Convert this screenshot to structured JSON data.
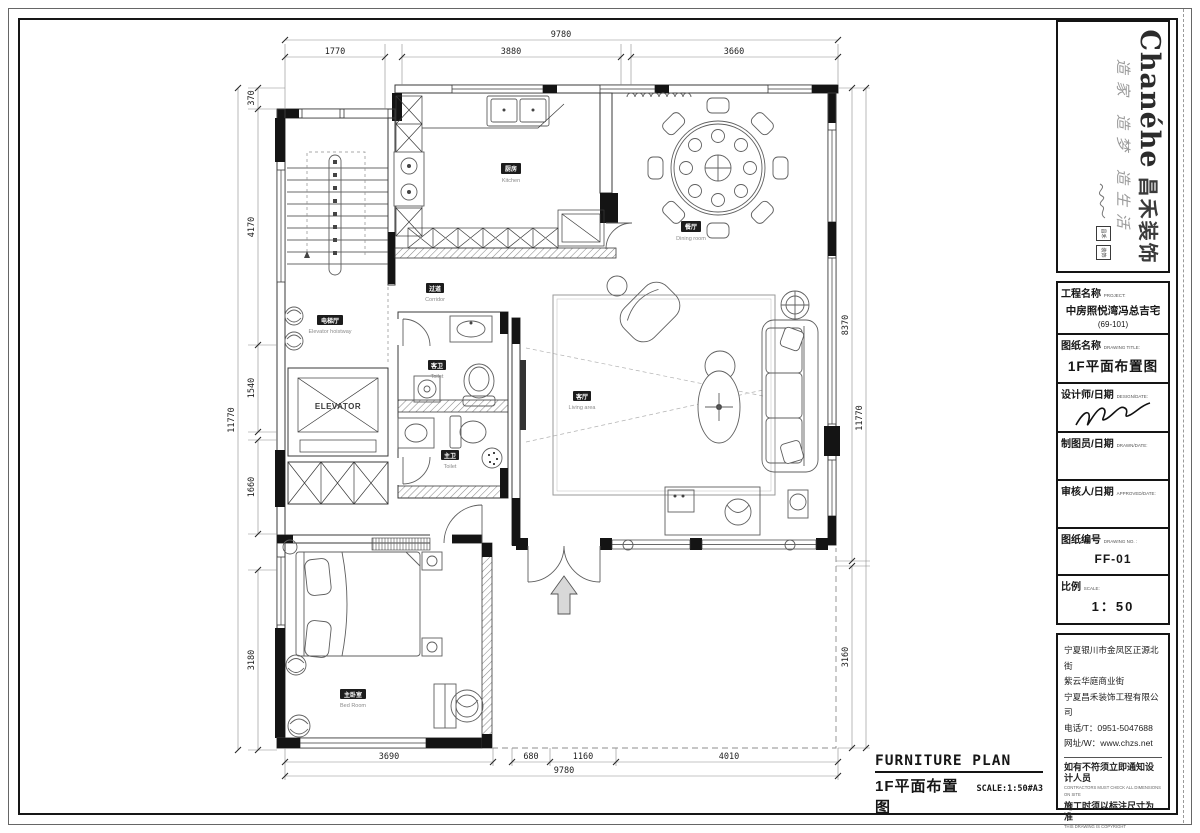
{
  "sheet": {
    "logo": {
      "brand_en": "Chanéhe",
      "brand_cn": "昌禾装饰",
      "slogan": "造家 造梦 造生活",
      "seal1": "昌禾",
      "seal2": "装饰"
    },
    "fields": {
      "project_label": "工程名称",
      "project_label_en": "PROJECT:",
      "project_value": "中房照悦湾冯总吉宅",
      "project_value2": "(69-101)",
      "drawing_label": "图纸名称",
      "drawing_label_en": "DRAWING TITLE:",
      "drawing_value": "1F平面布置图",
      "designer_label": "设计师/日期",
      "designer_label_en": "DESIGN/DATE:",
      "drafter_label": "制图员/日期",
      "drafter_label_en": "DRAWN/DATE:",
      "approver_label": "审核人/日期",
      "approver_label_en": "APPROVED/DATE:",
      "no_label": "图纸编号",
      "no_label_en": "DRAWING NO. :",
      "no_value": "FF-01",
      "scale_label": "比例",
      "scale_label_en": "SCALE:",
      "scale_value": "1：50"
    },
    "address": {
      "lines": [
        "宁夏银川市金凤区正源北街",
        "紫云华庭商业街",
        "宁夏昌禾装饰工程有限公司",
        "电话/T：0951-5047688",
        "网址/W：www.chzs.net"
      ]
    },
    "notes": {
      "cn1": "如有不符须立即通知设计人员",
      "en1": "CONTRACTORS MUST CHECK ALL DIMENSIONS ON SITE",
      "cn2": "施工时须以标注尺寸为准",
      "en2": "THIS DRAWING IS COPYRIGHT"
    },
    "footer": {
      "title_en": "FURNITURE PLAN",
      "title_cn": "1F平面布置图",
      "scale": "SCALE:1:50#A3"
    }
  },
  "plan": {
    "rooms": {
      "kitchen_cn": "厨房",
      "kitchen_en": "Kitchen",
      "dining_cn": "餐厅",
      "dining_en": "Dining room",
      "corridor_cn": "过道",
      "corridor_en": "Corridor",
      "elevator_hall_cn": "电梯厅",
      "elevator_hall_en": "Elevator hoistway",
      "toilet_guest_cn": "客卫",
      "toilet_guest_en": "Toilet",
      "living_cn": "客厅",
      "living_en": "Living area",
      "toilet_master_cn": "主卫",
      "toilet_master_en": "Toilet",
      "bedroom_cn": "主卧室",
      "bedroom_en": "Bed Room",
      "elevator": "ELEVATOR"
    },
    "dims": {
      "top": {
        "overall": "9780",
        "seg1": "1770",
        "seg2": "3880",
        "seg3": "3660"
      },
      "bottom": {
        "overall": "9780",
        "seg1": "3690",
        "seg2": "680",
        "seg3": "1160",
        "seg4": "4010"
      },
      "left": {
        "overall": "11770",
        "seg1": "370",
        "seg2": "4170",
        "seg3": "1540",
        "seg4": "1660",
        "seg5": "3180"
      },
      "right": {
        "overall": "11770",
        "seg1": "8370",
        "seg2": "3160"
      }
    }
  }
}
